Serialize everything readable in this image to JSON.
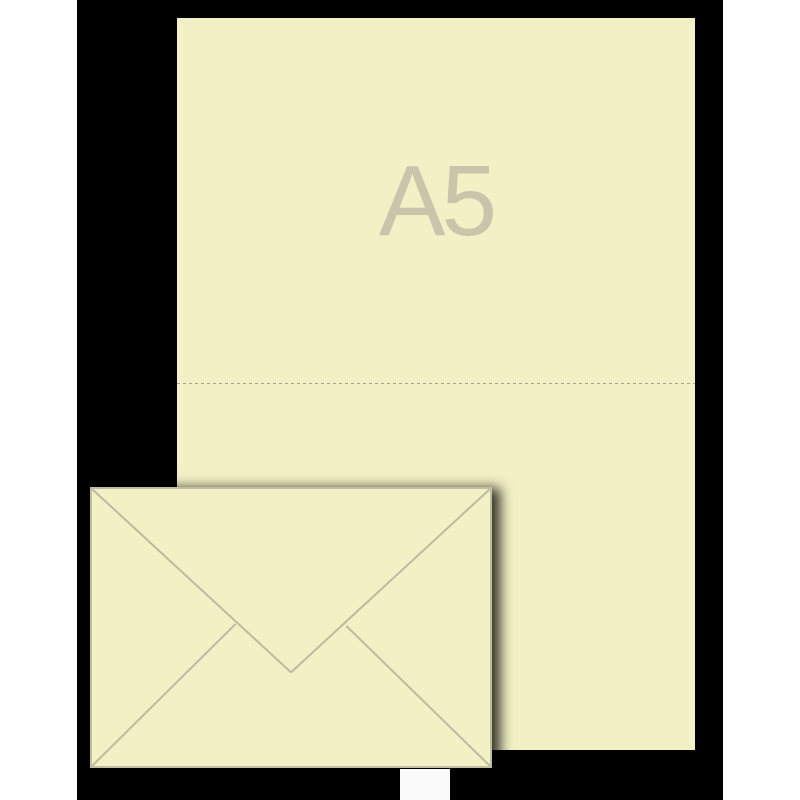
{
  "page": {
    "background_color": "#ffffff"
  },
  "product_image": {
    "background_color": "#000000",
    "sheet": {
      "size_label": "A5",
      "label_color": "#c8c5ab",
      "paper_color": "#f2f0c5",
      "fold_line_style": "dashed",
      "fold_line_color": "#a8a58a"
    },
    "envelope": {
      "paper_color": "#f2f0c5",
      "outline_color": "#c0bda2",
      "flap_line_color": "#bdbaa0",
      "shadow_color": "rgba(0,0,0,0.8)"
    }
  }
}
